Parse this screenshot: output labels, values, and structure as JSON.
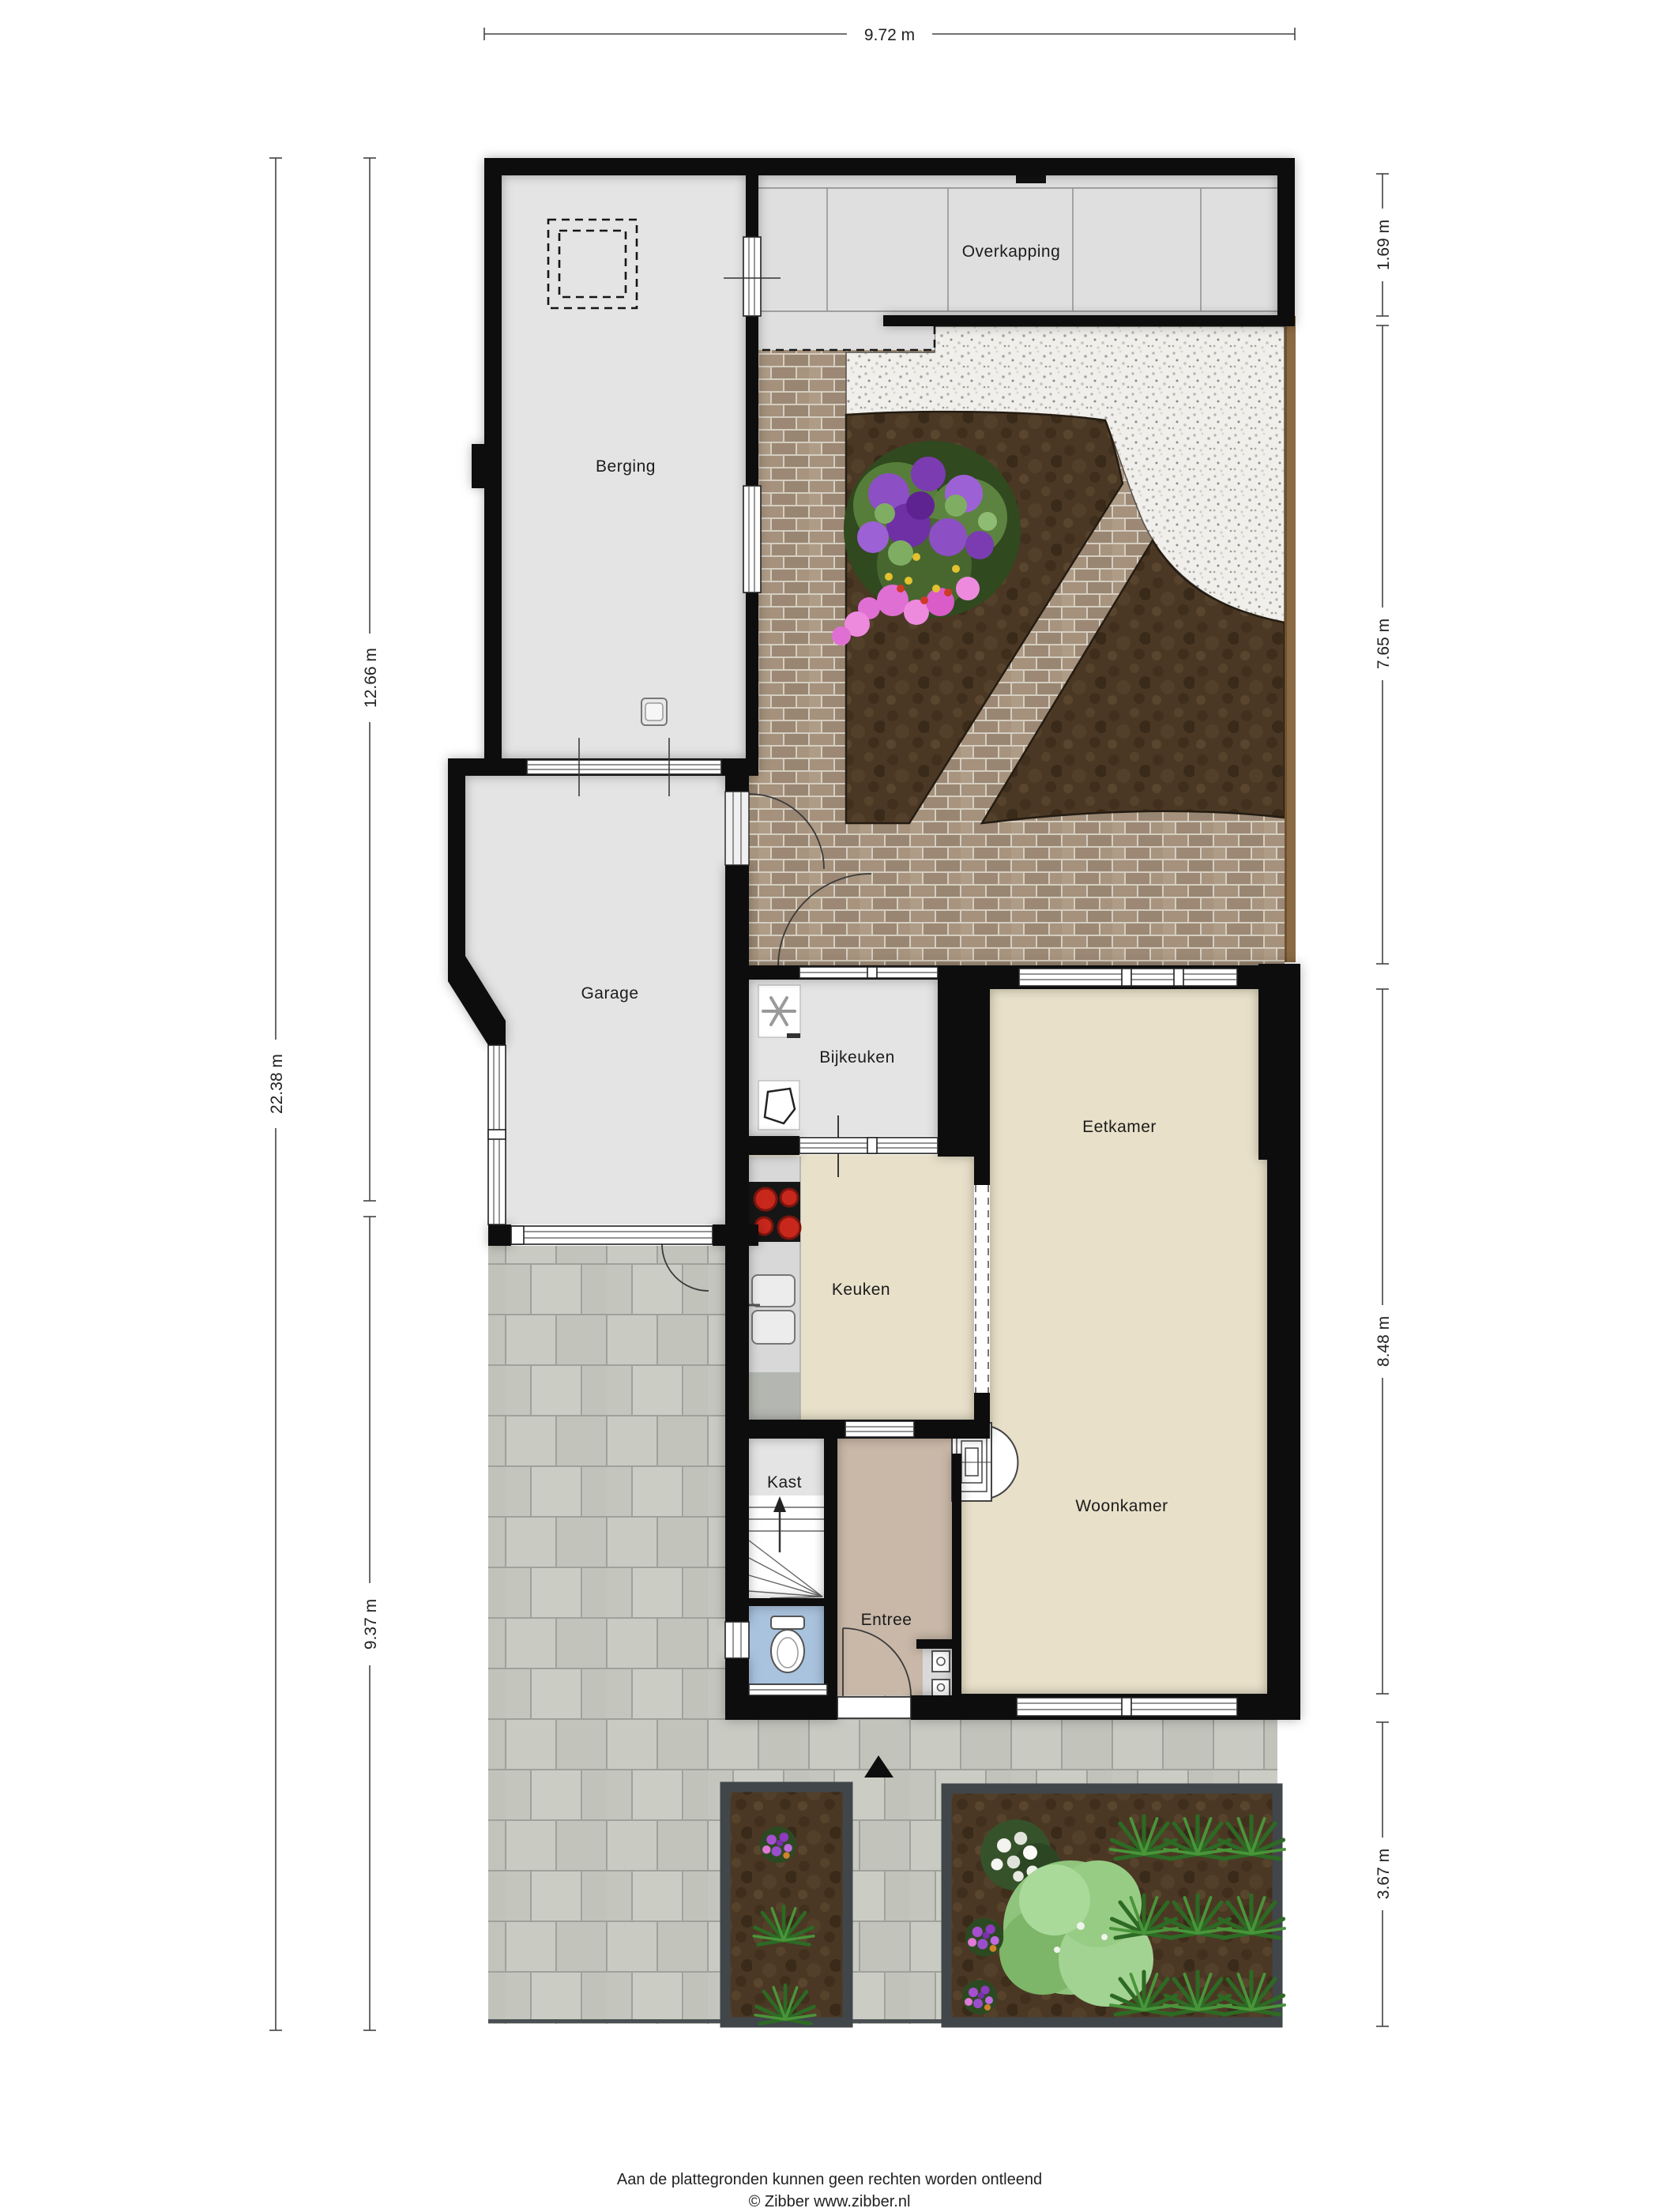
{
  "rooms": {
    "overkapping": "Overkapping",
    "berging": "Berging",
    "garage": "Garage",
    "bijkeuken": "Bijkeuken",
    "eetkamer": "Eetkamer",
    "keuken": "Keuken",
    "woonkamer": "Woonkamer",
    "kast": "Kast",
    "entree": "Entree"
  },
  "dimensions": {
    "top": "9.72 m",
    "left_total": "22.38 m",
    "left_upper": "12.66 m",
    "left_lower": "9.37 m",
    "right_top": "1.69 m",
    "right_garden": "7.65 m",
    "right_house": "8.48 m",
    "right_front": "3.67 m"
  },
  "footer": {
    "disclaimer": "Aan de plattegronden kunnen geen rechten worden ontleend",
    "copyright": "© Zibber www.zibber.nl"
  },
  "colors": {
    "wall": "#0d0d0d",
    "floor_gray": "#e4e4e4",
    "floor_beige": "#e8e0c9",
    "floor_entree": "#c9b8a8",
    "floor_toilet": "#a9c2dd",
    "soil": "#4b3824",
    "paving": "#c6c8c0",
    "brick": "#a5917c",
    "gravel": "#f1f0ec",
    "fence": "#8a6a43",
    "burner_red": "#cc2b20",
    "plant_green": "#2d6a24"
  }
}
